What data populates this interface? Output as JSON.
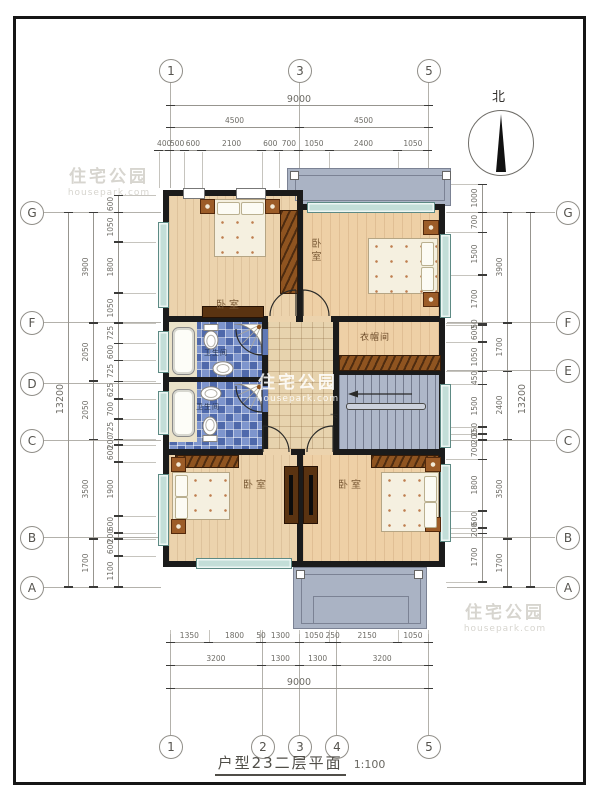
{
  "title": {
    "text": "户型23二层平面",
    "scale": "1:100"
  },
  "compass": {
    "label": "北"
  },
  "watermark": {
    "brand": "住宅公园",
    "site": "housepark.com"
  },
  "grid": {
    "top": [
      "1",
      "3",
      "5"
    ],
    "bottom": [
      "1",
      "2",
      "3",
      "4",
      "5"
    ],
    "left": [
      "G",
      "F",
      "D",
      "C",
      "B",
      "A"
    ],
    "right": [
      "G",
      "F",
      "E",
      "C",
      "B",
      "A"
    ]
  },
  "dimensions": {
    "top_total": "9000",
    "top_halves": [
      "4500",
      "4500"
    ],
    "top_detail": [
      "400",
      "500",
      "600",
      "2100",
      "600",
      "700",
      "1050",
      "2400",
      "1050"
    ],
    "bottom_detail": [
      "1350",
      "1800",
      "50",
      "1300",
      "1050",
      "250",
      "2150",
      "1050"
    ],
    "bottom_mid": [
      "3200",
      "1300",
      "1300",
      "3200"
    ],
    "bottom_total": "9000",
    "left_outer": "13200",
    "left_mid": [
      "3900",
      "2050",
      "2050",
      "3500",
      "1700"
    ],
    "left_inner": [
      "600",
      "1050",
      "1800",
      "1050",
      "725",
      "600",
      "725",
      "625",
      "700",
      "725",
      "200",
      "600",
      "1900",
      "600",
      "200",
      "600",
      "1100"
    ],
    "right_outer": "13200",
    "right_mid": [
      "3900",
      "1700",
      "2400",
      "3500",
      "1700"
    ],
    "right_inner": [
      "1000",
      "700",
      "1500",
      "1700",
      "50",
      "600",
      "1050",
      "450",
      "1500",
      "250",
      "200",
      "700",
      "1800",
      "600",
      "200",
      "1700"
    ]
  },
  "rooms": {
    "bedroom_tl": "卧室",
    "bedroom_tr": "卧室",
    "bedroom_bl": "卧室",
    "bedroom_br": "卧室",
    "bath_top": "卫生间",
    "bath_bottom": "卫生间",
    "cloakroom": "衣帽间",
    "stairs_down": "下"
  },
  "colors": {
    "wall": "#1b1b1b",
    "wood_floor": "#ecd3ad",
    "tile_floor": "#e7d3ae",
    "bath_tile": "#5f78b5",
    "stair_floor": "#aeb7c9",
    "balcony_floor": "#aab3c4",
    "window": "#c3ded8",
    "furniture_wood": "#8f5420",
    "dim_text": "#6e6c66"
  }
}
